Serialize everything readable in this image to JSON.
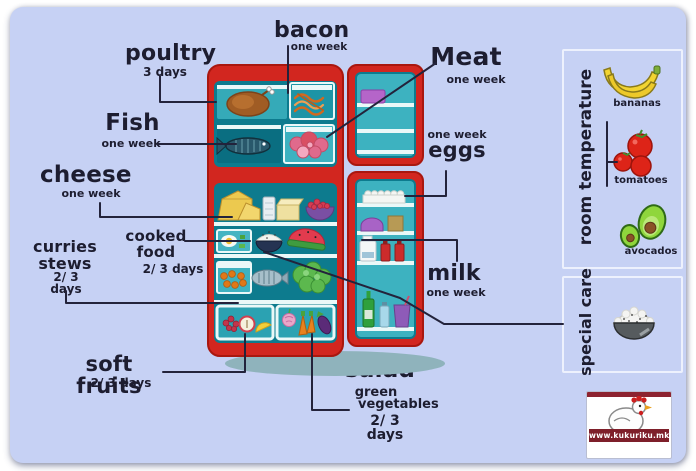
{
  "colors": {
    "panel_background": "#c6d1f4",
    "fridge_body_red": "#d2261f",
    "fridge_interior_teal": "#0d7b8e",
    "shelf_teal": "#3db2c0",
    "connector_line": "#23233b",
    "text": "#1d1d30"
  },
  "labels": {
    "poultry": {
      "name": "poultry",
      "duration": "3 days"
    },
    "bacon": {
      "name": "bacon",
      "duration": "one week"
    },
    "meat": {
      "name": "Meat",
      "duration": "one week"
    },
    "fish": {
      "name": "Fish",
      "duration": "one week"
    },
    "cheese": {
      "name": "cheese",
      "duration": "one week"
    },
    "cooked_food": {
      "line1": "cooked",
      "line2": "food",
      "duration": "2/ 3 days"
    },
    "curries_stews": {
      "line1": "curries",
      "line2": "stews",
      "duration": "2/ 3 days"
    },
    "soft_fruits": {
      "name": "soft fruits",
      "duration": "2/ 3 days"
    },
    "salad": {
      "name": "salad",
      "line2": "green",
      "line3": "vegetables",
      "duration": "2/ 3 days"
    },
    "eggs": {
      "duration": "one week",
      "name": "eggs"
    },
    "milk": {
      "name": "milk",
      "duration": "one week"
    }
  },
  "fridge_contents": {
    "freezer_top_shelf": [
      "turkey (poultry)",
      "bacon"
    ],
    "freezer_bottom_shelf": [
      "fish",
      "meat"
    ],
    "shelf_1": [
      "cheese",
      "glass",
      "butter",
      "bowl of berries"
    ],
    "shelf_2": [
      "cooked food",
      "rice bowl",
      "watermelon"
    ],
    "shelf_3": [
      "curries / stews",
      "wrapped fish",
      "salad greens"
    ],
    "left_drawer": [
      "soft fruits",
      "apple",
      "lemon"
    ],
    "right_drawer": [
      "onion",
      "carrots",
      "aubergine"
    ],
    "door_top": [
      "frozen pack"
    ],
    "door_shelves": [
      "eggs tray",
      "butter dish",
      "milk",
      "ketchup bottles",
      "drink bottles"
    ]
  },
  "side_panel": {
    "room_temperature": {
      "title": "room temperature",
      "items": [
        {
          "name": "bananas"
        },
        {
          "name": "tomatoes"
        },
        {
          "name": "avocados"
        }
      ]
    },
    "special_care": {
      "title": "special care",
      "item": "bowl of rice"
    }
  },
  "logo": {
    "website": "www.kukuriku.mk"
  }
}
